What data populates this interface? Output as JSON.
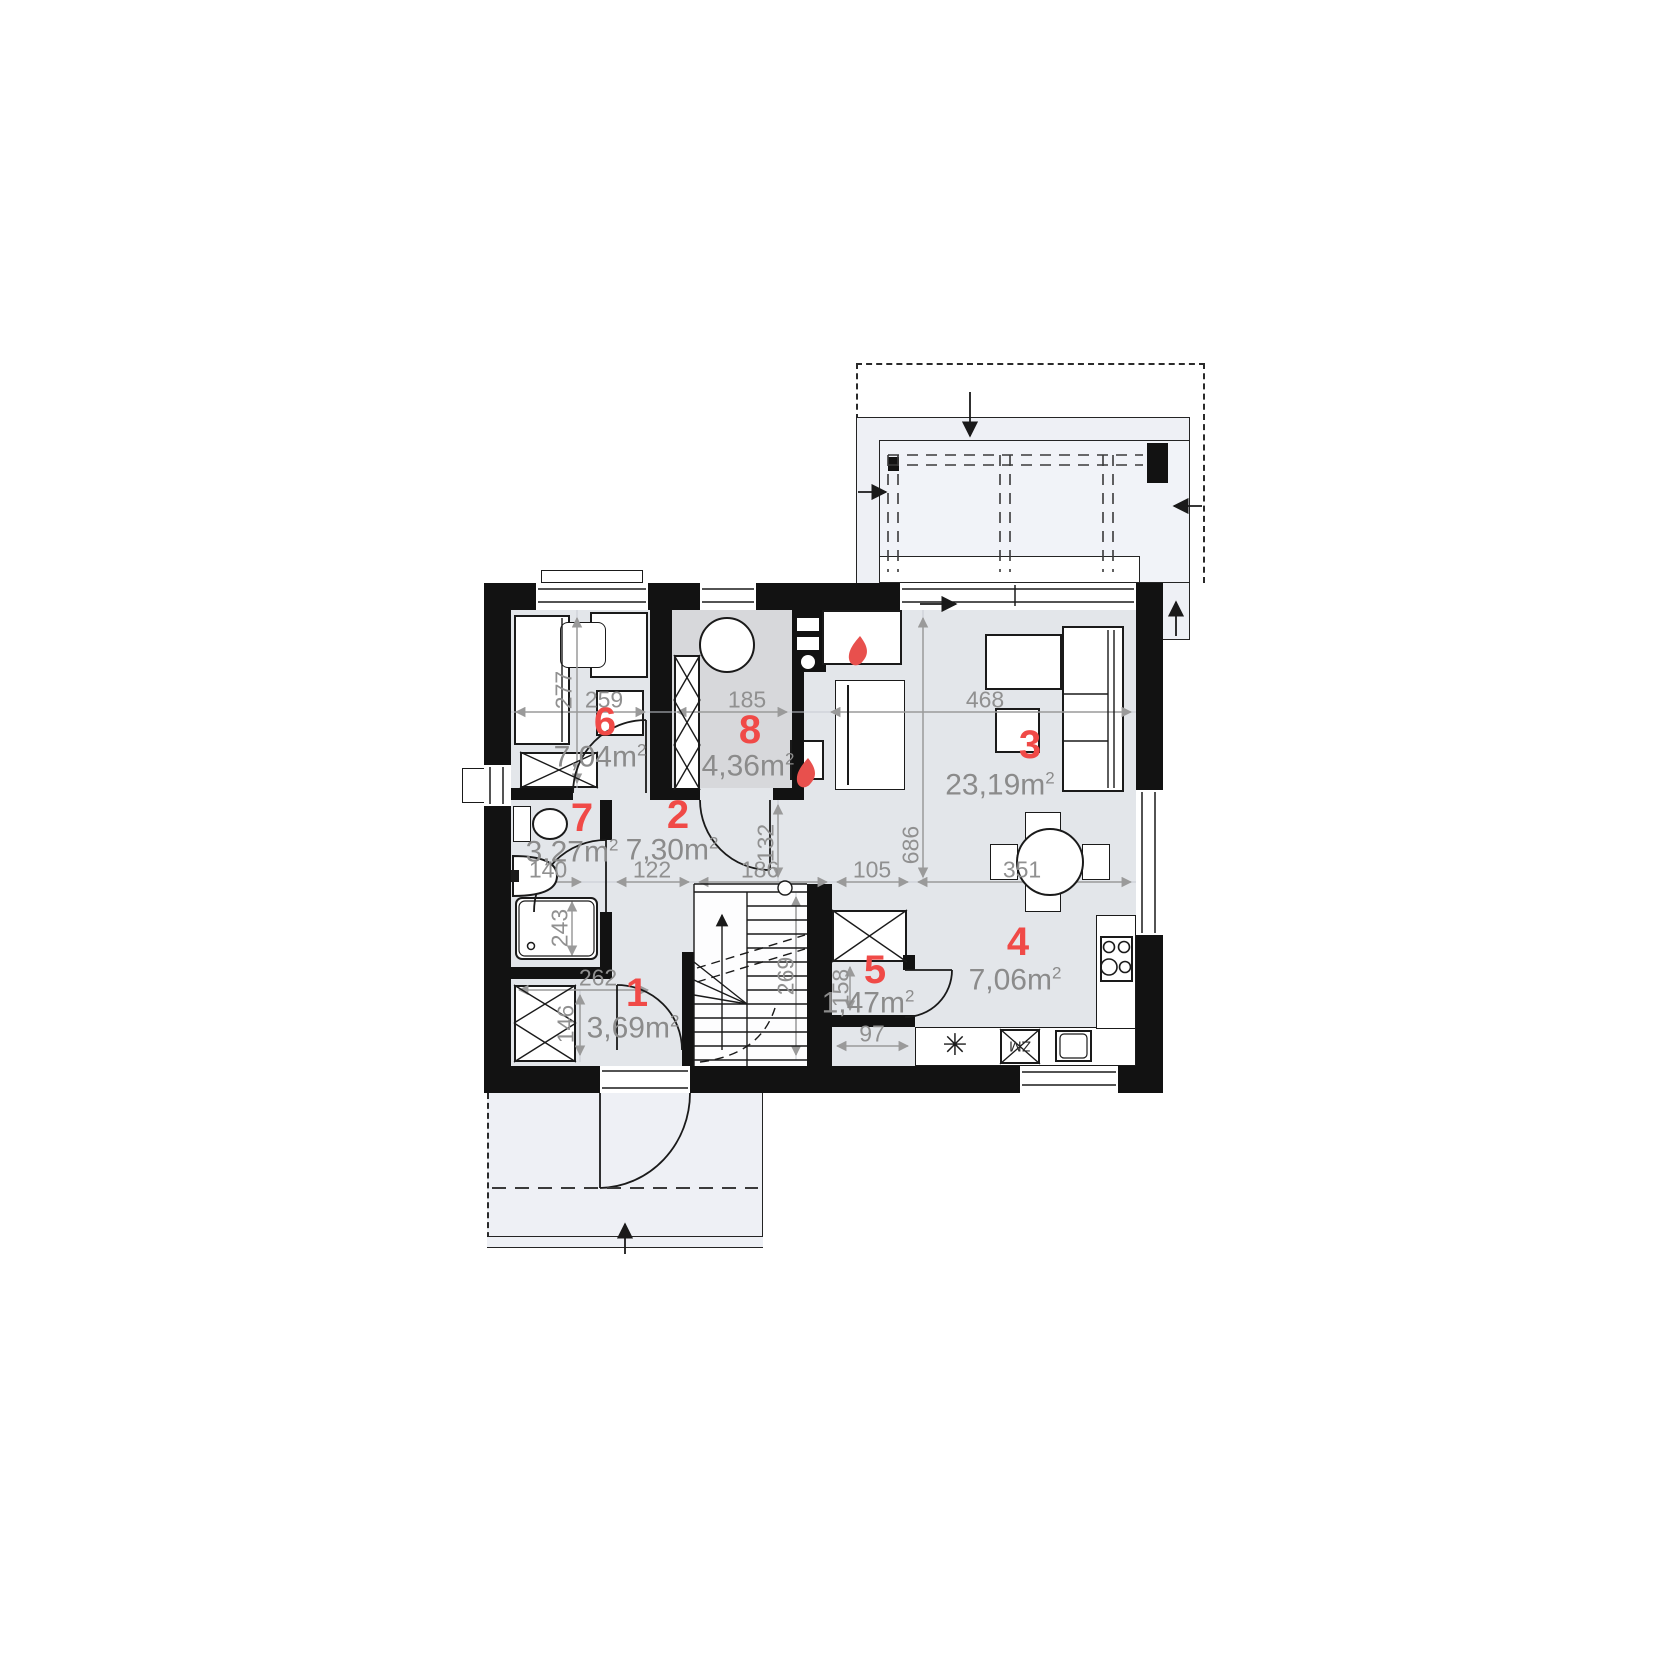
{
  "rooms": [
    {
      "number": "1",
      "area": "3,69"
    },
    {
      "number": "2",
      "area": "7,30"
    },
    {
      "number": "3",
      "area": "23,19"
    },
    {
      "number": "4",
      "area": "7,06"
    },
    {
      "number": "5",
      "area": "1,47"
    },
    {
      "number": "6",
      "area": "7,04"
    },
    {
      "number": "7",
      "area": "3,27"
    },
    {
      "number": "8",
      "area": "4,36"
    }
  ],
  "units": {
    "suffix": "m",
    "sup": "2"
  },
  "dims": {
    "d277": "277",
    "d259": "259",
    "d185": "185",
    "d468": "468",
    "d686": "686",
    "d132": "132",
    "d140": "140",
    "d122": "122",
    "d186": "186",
    "d105": "105",
    "d351": "351",
    "d243": "243",
    "d262": "262",
    "d146": "146",
    "d269": "269",
    "d158": "158",
    "d97": "97"
  },
  "labels": {
    "dishwasher": "ZM",
    "sink_symbol": "✳"
  },
  "colors": {
    "wall": "#121212",
    "room_floor": "#e3e6ea",
    "utility_floor": "#d7d8db",
    "outdoor_floor": "#eef0f5",
    "accent_red": "#f04a47",
    "dim_gray": "#909090",
    "flame_red": "#e8504d"
  }
}
